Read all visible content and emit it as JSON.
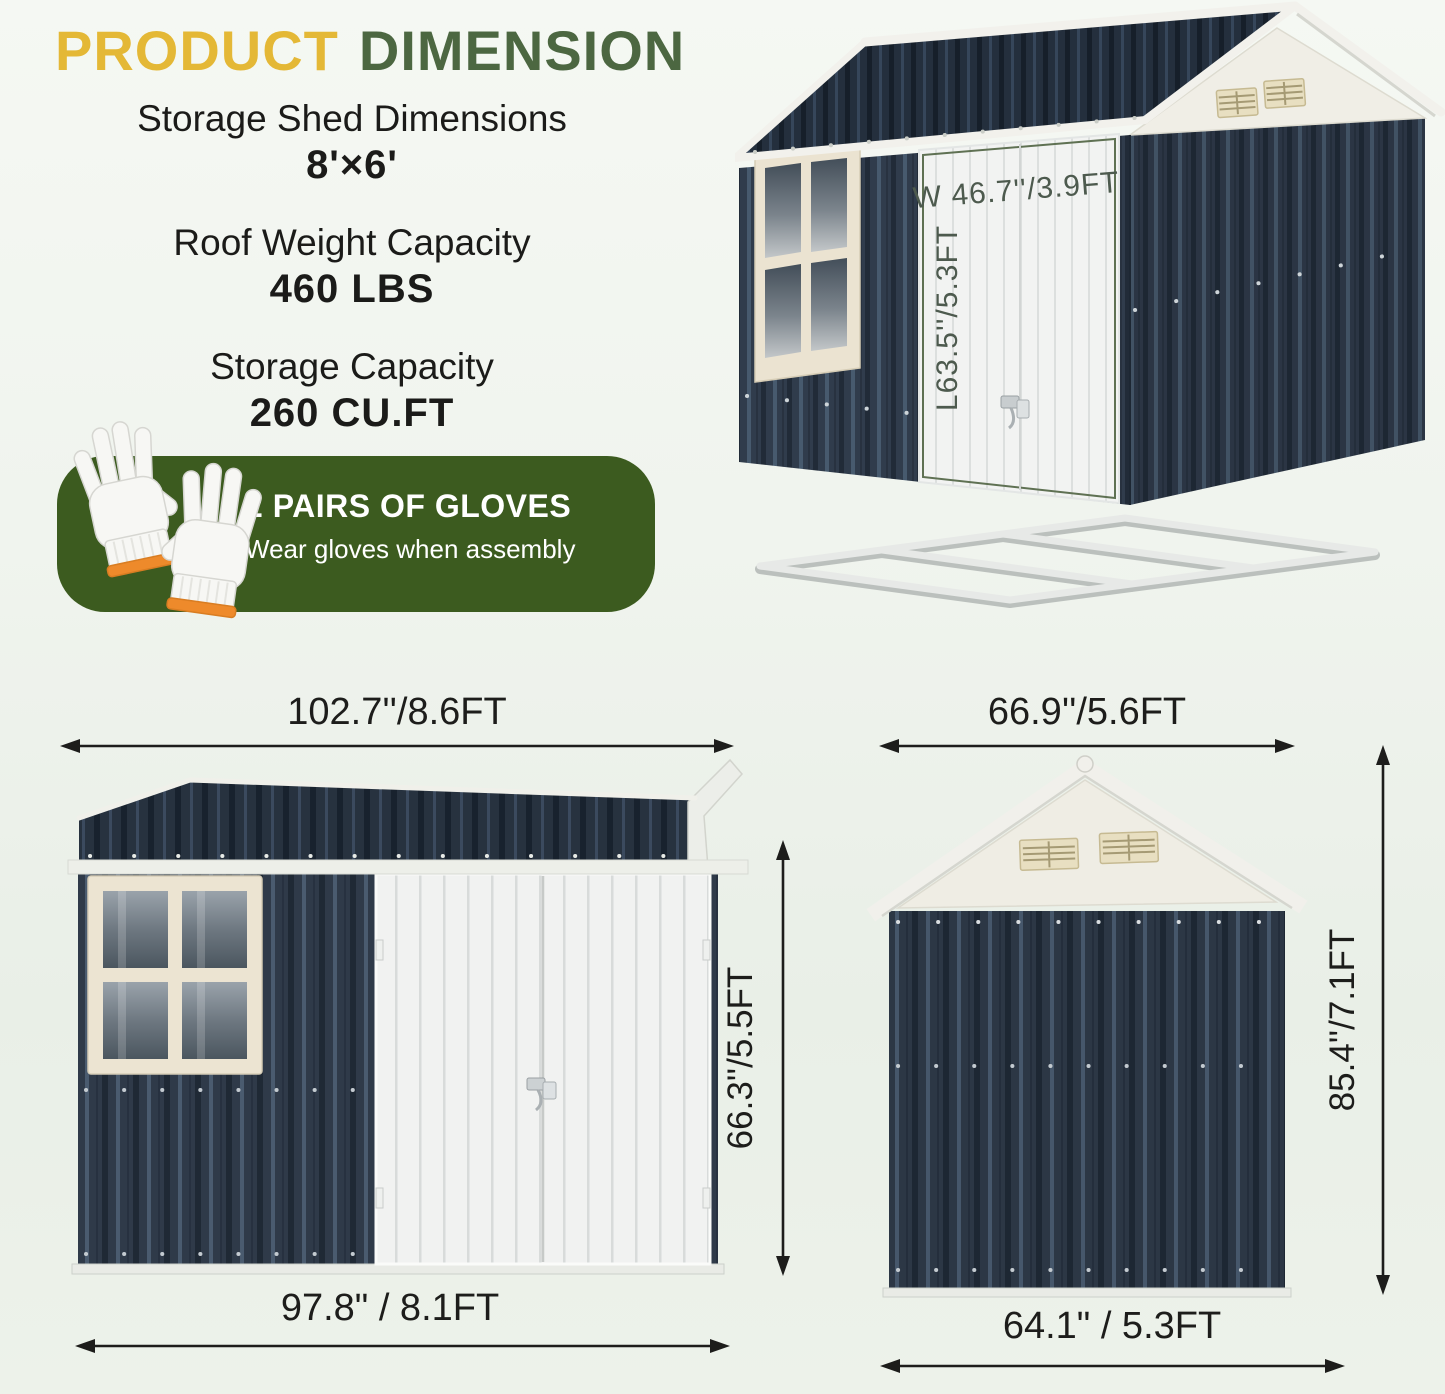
{
  "palette": {
    "title_yellow": "#E4B836",
    "title_green": "#4C6741",
    "banner_green": "#3C5B1F",
    "shed_dark": "#2F3A49",
    "roof_dark": "#27323F",
    "trim_white": "#F2F1EC",
    "cream": "#ECE4D1",
    "glove_cuff_orange": "#EE8A2B",
    "dimension_text": "#1D1D1B"
  },
  "header": {
    "title": {
      "part1": "PRODUCT",
      "part2": "DIMENSION"
    },
    "specs": [
      {
        "label": "Storage Shed Dimensions",
        "value": "8'×6'"
      },
      {
        "label": "Roof Weight Capacity",
        "value": "460 LBS"
      },
      {
        "label": "Storage Capacity",
        "value": "260 CU.FT"
      }
    ]
  },
  "gloves_banner": {
    "title": "2 PAIRS OF GLOVES",
    "subtitle": "Wear gloves when assembly"
  },
  "iso_view": {
    "door_width": "W 46.7''/3.9FT",
    "door_height": "L63.5''/5.3FT"
  },
  "front_view": {
    "width_top": "102.7''/8.6FT",
    "width_bottom": "97.8\" / 8.1FT",
    "height": "66.3''/5.5FT"
  },
  "side_view": {
    "width_top": "66.9''/5.6FT",
    "width_bottom": "64.1\" / 5.3FT",
    "height": "85.4''/7.1FT"
  }
}
